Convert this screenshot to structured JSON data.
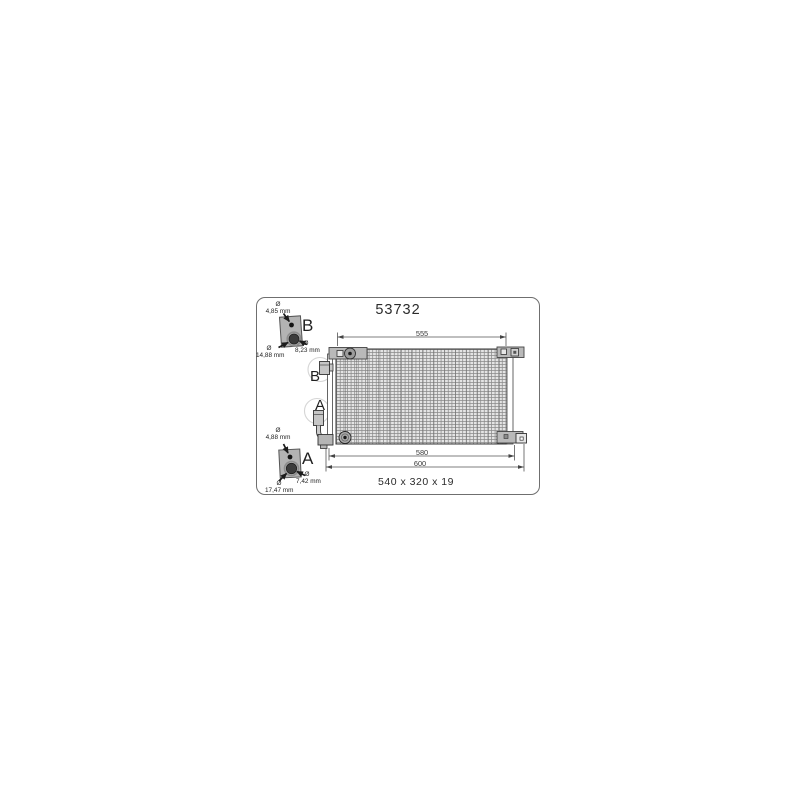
{
  "frame": {
    "part_number": "53732",
    "core_size": "540 x 320 x 19"
  },
  "dimensions": {
    "top_width_mm": "555",
    "bottom_inner_width_mm": "580",
    "bottom_outer_width_mm": "600"
  },
  "connections": {
    "b": "B",
    "a": "A"
  },
  "detail_b": {
    "letter": "B",
    "top_hole": {
      "sym": "Ø",
      "value": "4,85 mm"
    },
    "main_hole": {
      "sym": "Ø",
      "value": "8,23 mm"
    },
    "outer_hole": {
      "sym": "Ø",
      "value": "14,88 mm"
    }
  },
  "detail_a": {
    "letter": "A",
    "top_hole": {
      "sym": "Ø",
      "value": "4,88 mm"
    },
    "main_hole": {
      "sym": "Ø",
      "value": "7,42 mm"
    },
    "outer_hole": {
      "sym": "Ø",
      "value": "17,47 mm"
    }
  },
  "colors": {
    "line": "#3c3c3c",
    "bracket_fill": "#b5b5b5",
    "hatch": "#8a8a8a",
    "background": "#ffffff"
  }
}
